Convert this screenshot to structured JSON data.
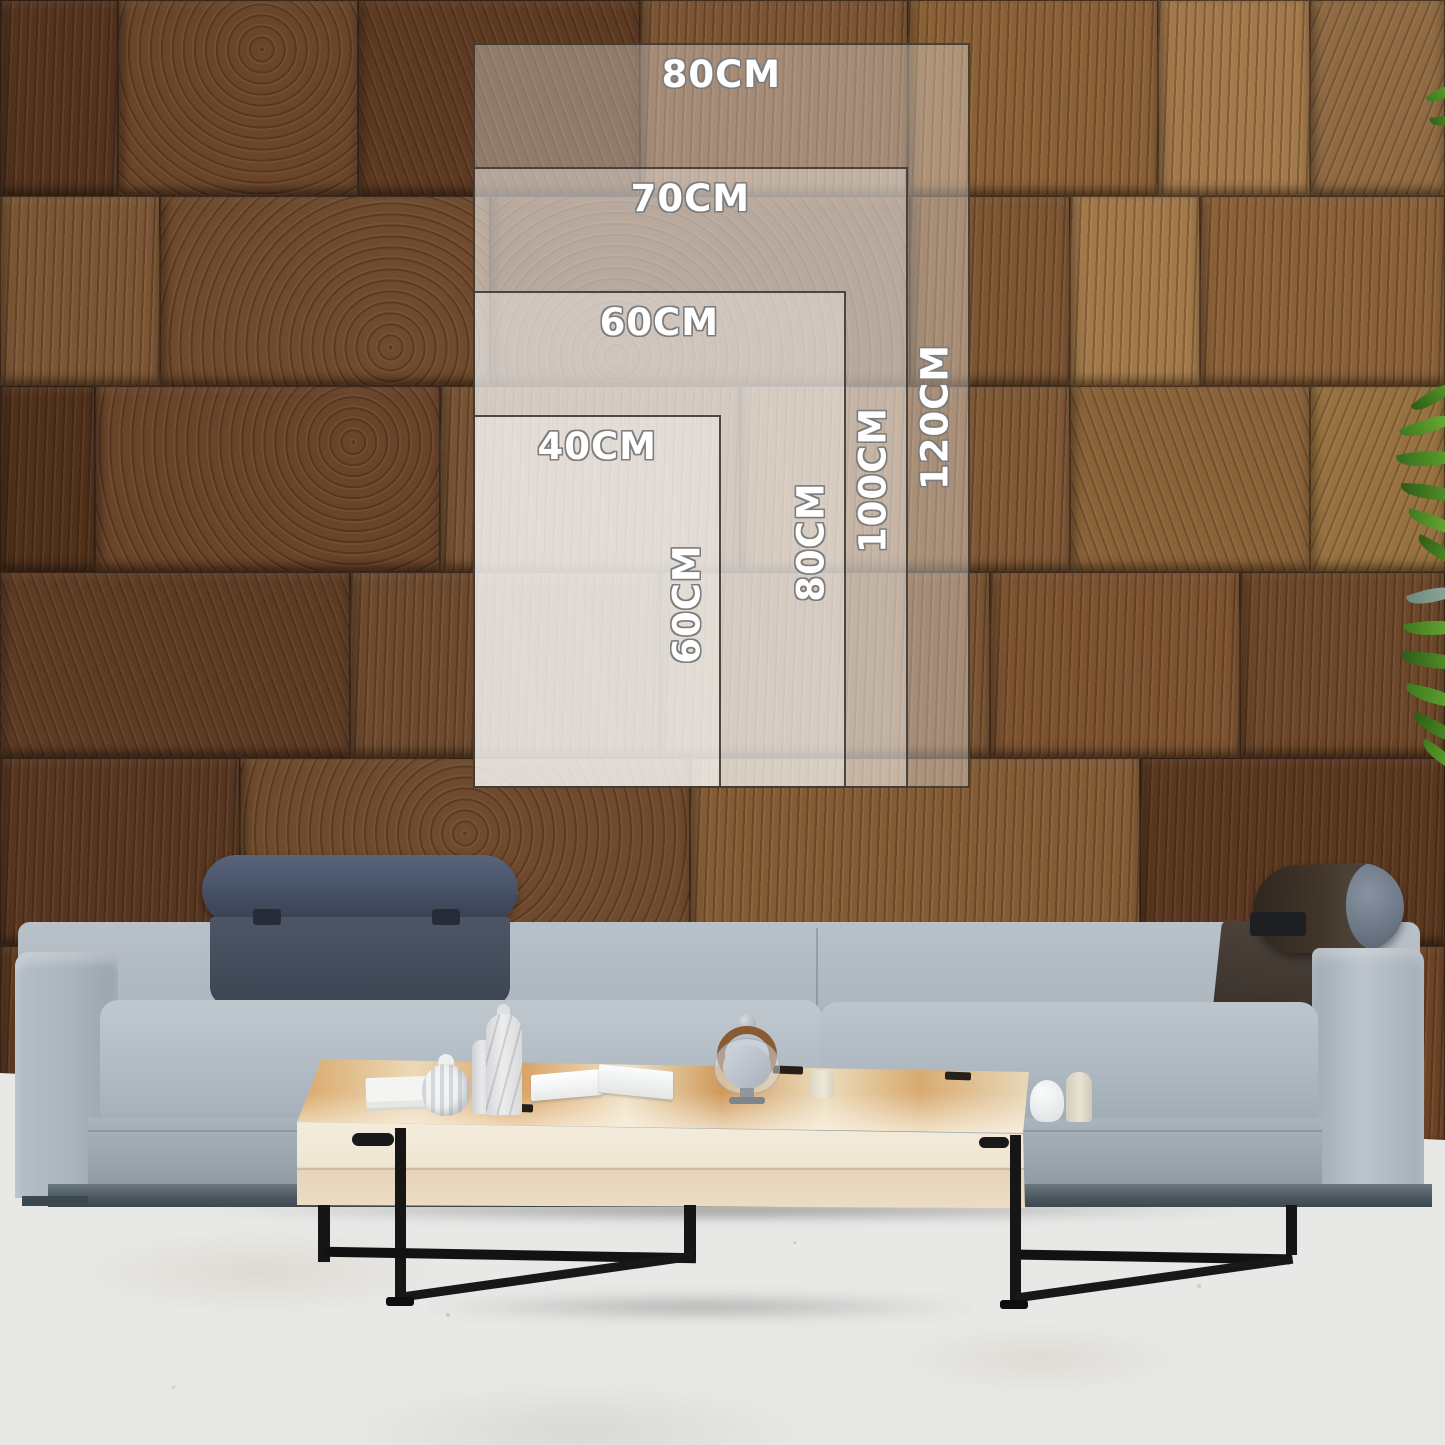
{
  "size_guide": {
    "unit": "CM",
    "sizes": [
      {
        "id": "80x120",
        "width_cm": 80,
        "height_cm": 120,
        "width_label": "80CM",
        "height_label": "120CM"
      },
      {
        "id": "70x100",
        "width_cm": 70,
        "height_cm": 100,
        "width_label": "70CM",
        "height_label": "100CM"
      },
      {
        "id": "60x80",
        "width_cm": 60,
        "height_cm": 80,
        "width_label": "60CM",
        "height_label": "80CM"
      },
      {
        "id": "40x60",
        "width_cm": 40,
        "height_cm": 60,
        "width_label": "40CM",
        "height_label": "60CM"
      }
    ],
    "label_text_color": "#ffffff",
    "label_outline_color": "#7d7d7d",
    "rect_fill": "rgba(255,255,255,0.33)",
    "rect_border_color": "#38342f"
  },
  "colors": {
    "wall_dark": "#53331d",
    "wall_mid": "#6f4a2c",
    "wall_light": "#a3784a",
    "sofa_fabric": "#aeb8c0",
    "sofa_fabric_shadow": "#97a1aa",
    "sofa_base": "#56626a",
    "headrest_quilted": "#49525f",
    "headrest_bolster": "#3f352b",
    "bolster_end_cap": "#6f7a88",
    "table_wood": "#e2c796",
    "table_face": "#efe6d2",
    "metal_leg": "#161616",
    "floor": "#e9e9e7",
    "leaf_green": "#4e8f24"
  }
}
